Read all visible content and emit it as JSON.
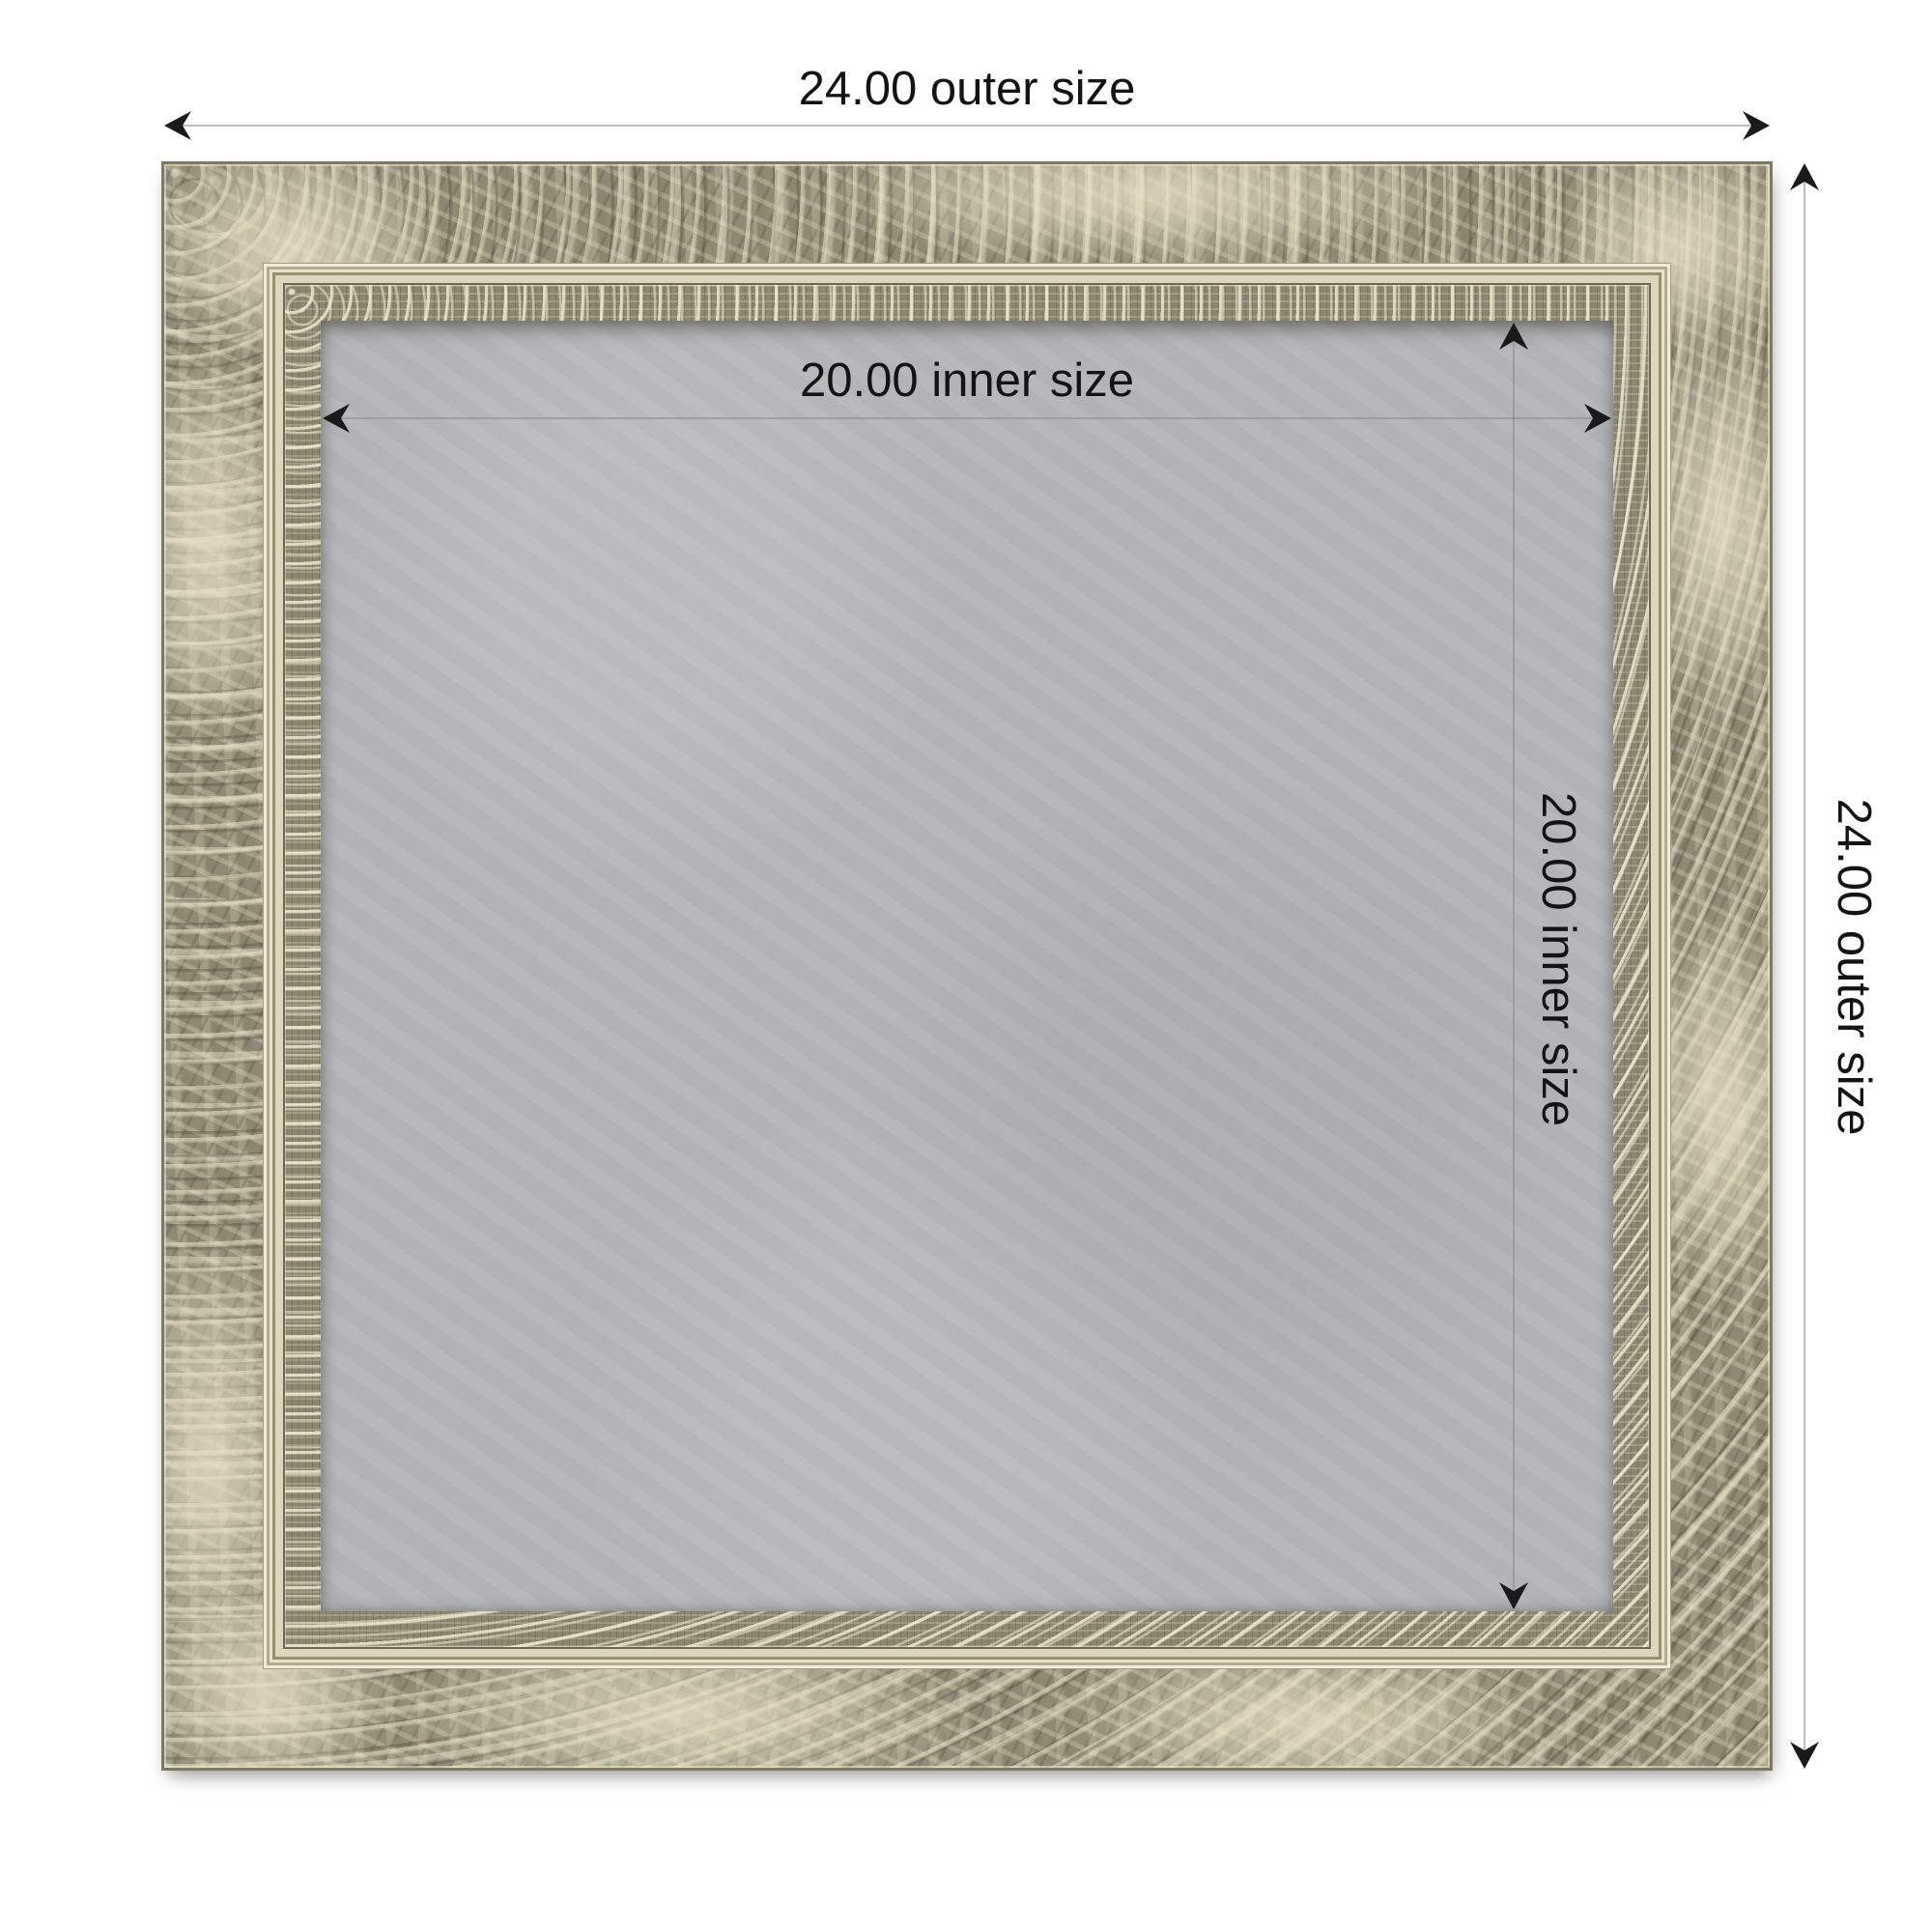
{
  "diagram": {
    "type": "product-dimension-diagram",
    "product": "ornate distressed silver frame with gray magnetic board",
    "outer_size_value": 24.0,
    "inner_size_value": 20.0,
    "labels": {
      "outer_width": "24.00 outer size",
      "outer_height": "24.00 outer size",
      "inner_width": "20.00 inner size",
      "inner_height": "20.00 inner size"
    },
    "icons": {
      "arrowhead": "black dart chevron arrowhead"
    }
  },
  "colors": {
    "background": "#ffffff",
    "dimension_line": "#a9a9a9",
    "inner_dimension_line": "#8e8e8e",
    "arrowhead": "#1a1a1a",
    "label_text": "#141414",
    "board": "#b5b6b8",
    "frame_base": "#8f8a74",
    "frame_ornament": "#d8d0b4",
    "frame_lip": "#ddd6bd",
    "frame_edge": "#7e7965"
  }
}
